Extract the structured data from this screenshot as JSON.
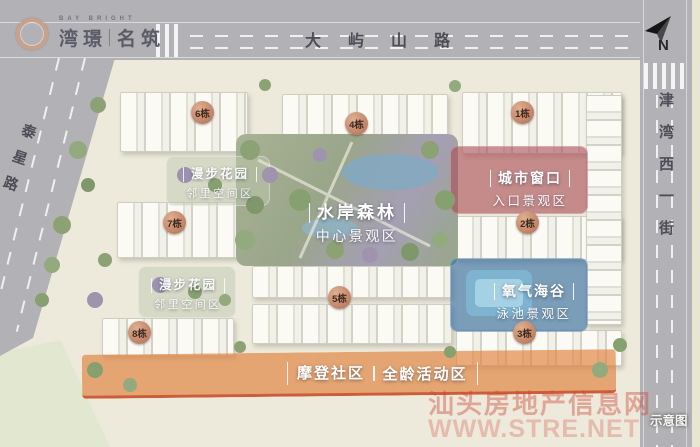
{
  "logo": {
    "tagline": "BAY BRIGHT",
    "name_part1": "湾璟",
    "name_part2": "名筑"
  },
  "compass": {
    "north": "N"
  },
  "roads": {
    "top": "大屿山路",
    "right": "津湾西一街",
    "left": "泰星路"
  },
  "zones": {
    "center": {
      "title": "水岸森林",
      "subtitle": "中心景观区"
    },
    "entrance": {
      "title": "城市窗口",
      "subtitle": "入口景观区"
    },
    "pool": {
      "title": "氧气海谷",
      "subtitle": "泳池景观区"
    },
    "garden_upper": {
      "title": "漫步花园",
      "subtitle": "邻里空间区"
    },
    "garden_lower": {
      "title": "漫步花园",
      "subtitle": "邻里空间区"
    },
    "community": {
      "title": "摩登社区",
      "subtitle": "全龄活动区"
    }
  },
  "buildings": [
    {
      "label": "1栋"
    },
    {
      "label": "2栋"
    },
    {
      "label": "3栋"
    },
    {
      "label": "4栋"
    },
    {
      "label": "5栋"
    },
    {
      "label": "6栋"
    },
    {
      "label": "7栋"
    },
    {
      "label": "8栋"
    }
  ],
  "watermark": {
    "line1": "汕头房地产信息网",
    "line2": "WWW.STRE.NET",
    "note": "示意图"
  },
  "colors": {
    "road": "#b2b2b6",
    "site": "#edeadb",
    "badge": "#c08165",
    "zone_red": "#aa4b55",
    "zone_blue": "#2d69a0",
    "zone_orange": "#e0803a",
    "park_green": "#a3ae90"
  }
}
